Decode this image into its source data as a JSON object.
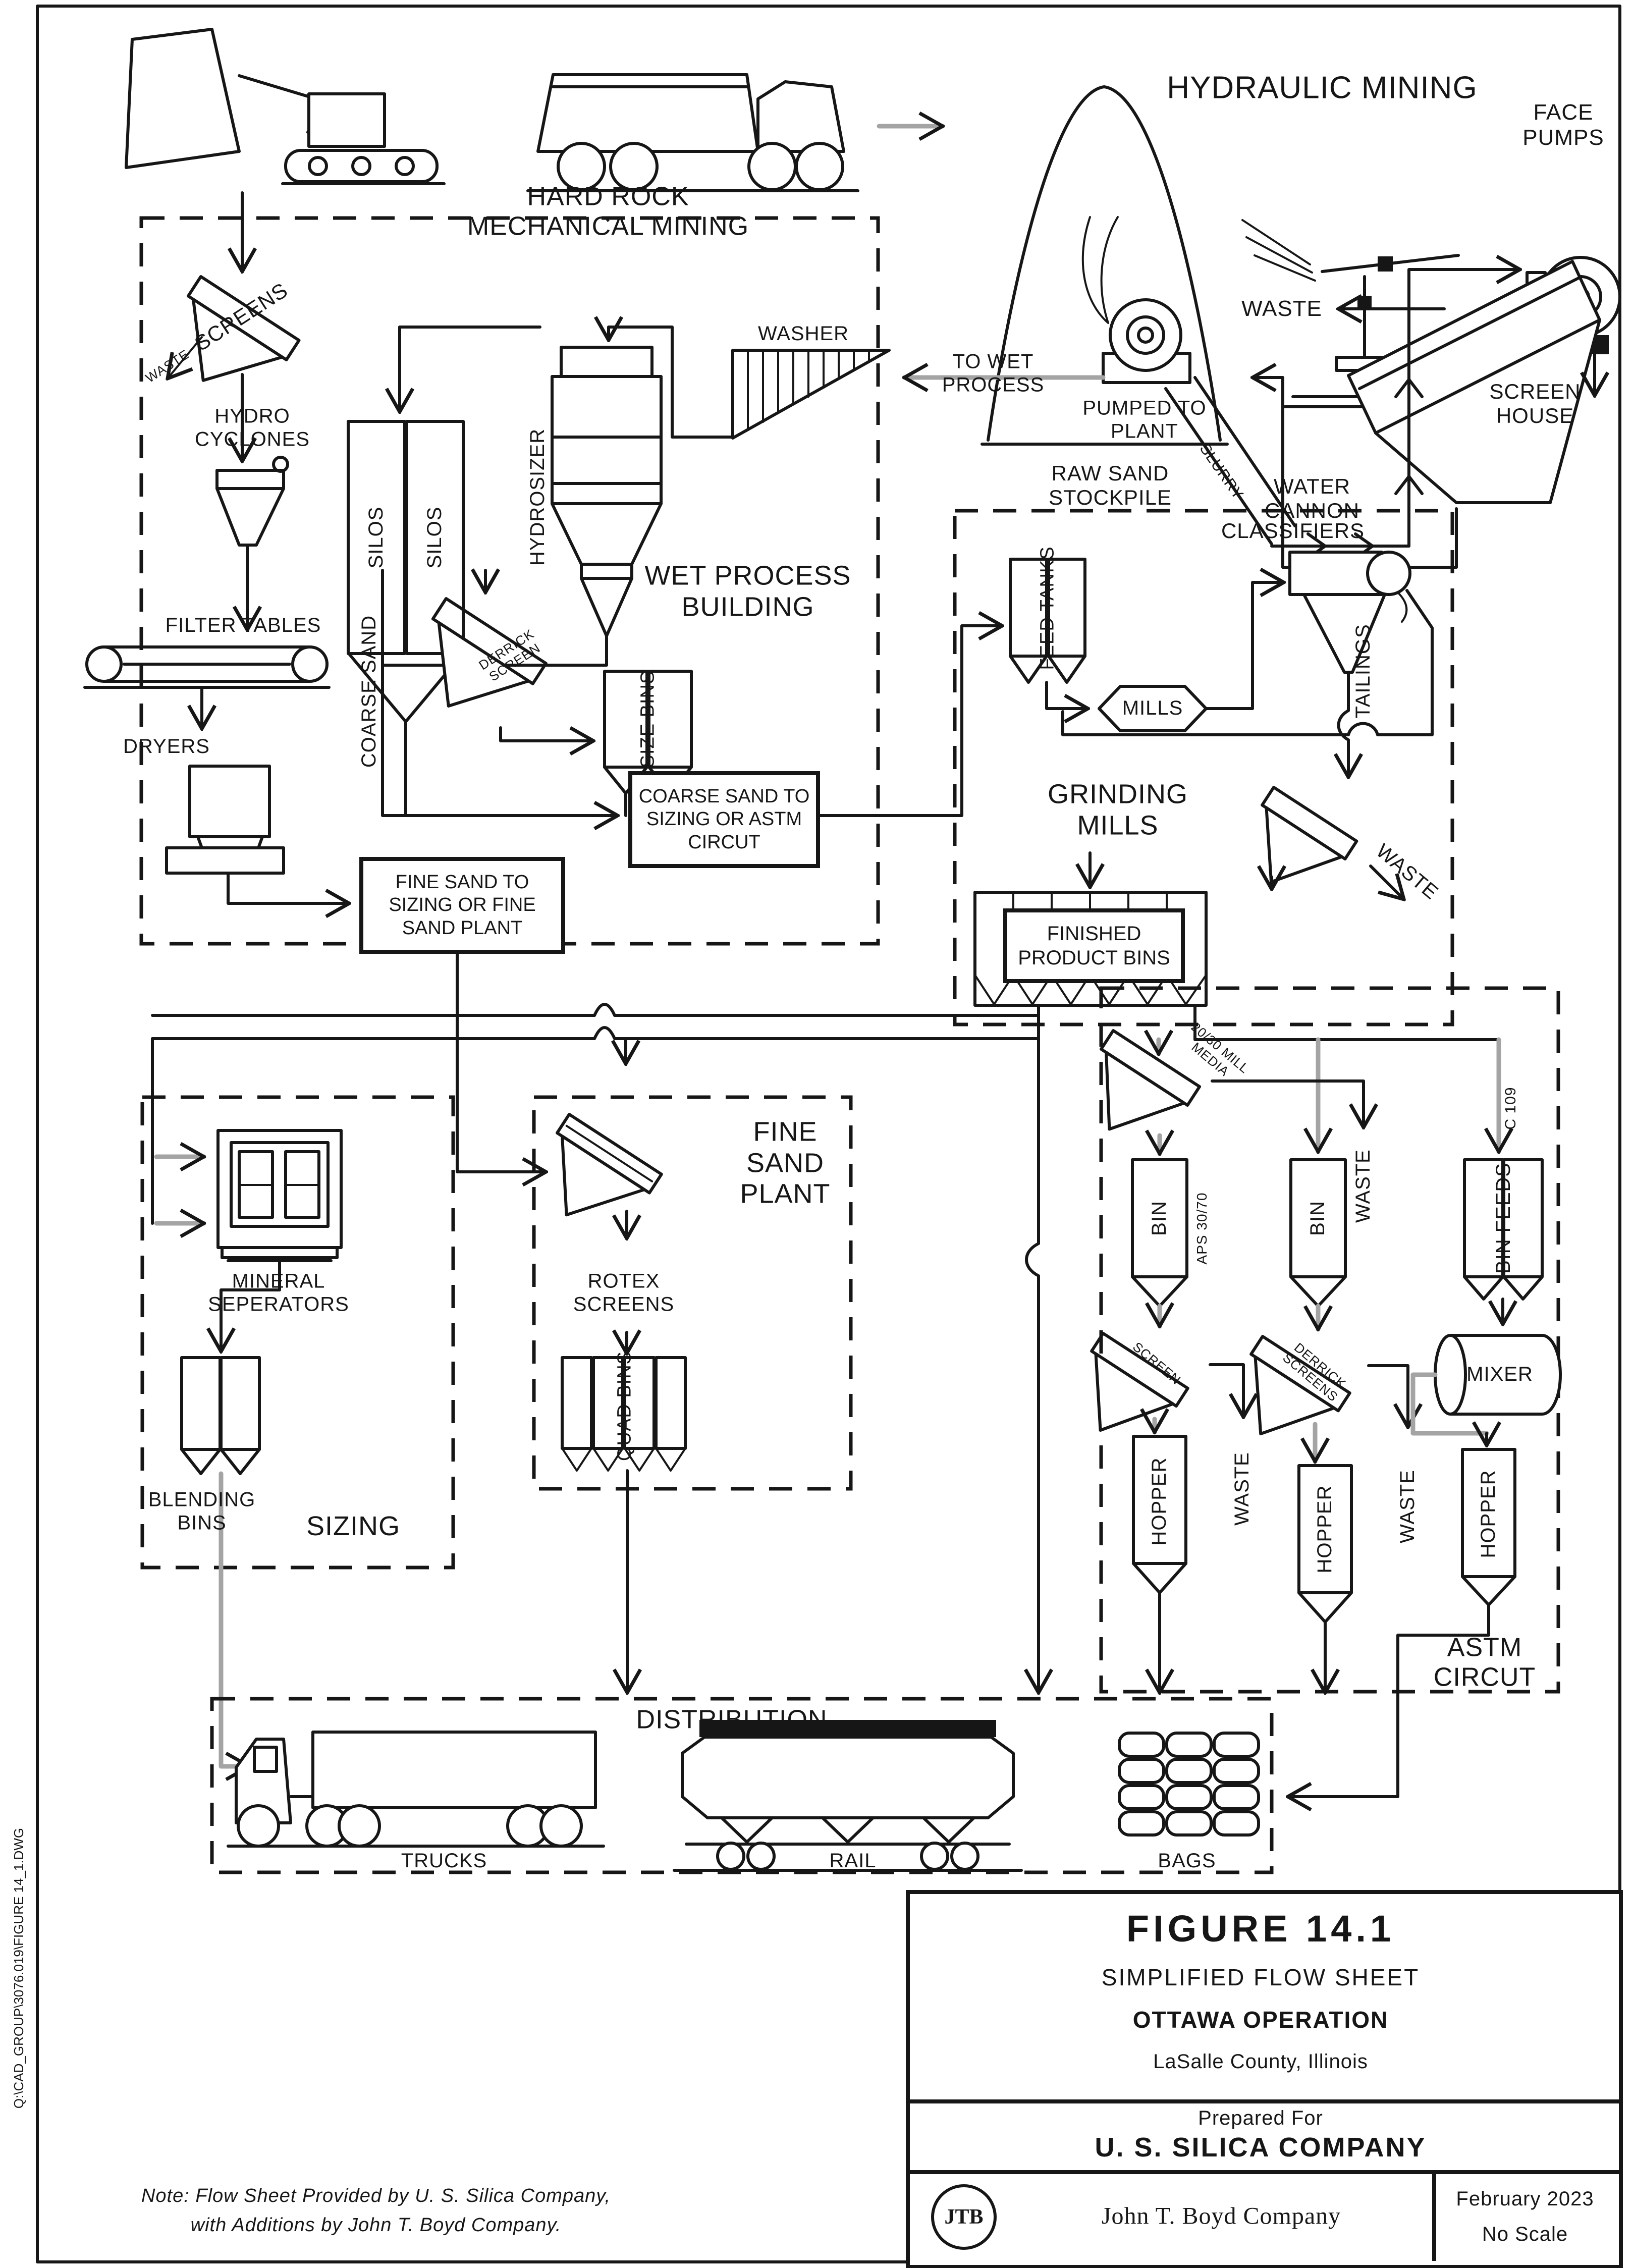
{
  "colors": {
    "ink": "#161616",
    "flow_gray": "#a4a4a4",
    "paper": "#ffffff"
  },
  "mining": {
    "hard_rock": "HARD ROCK MECHANICAL MINING",
    "hydraulic": "HYDRAULIC MINING",
    "face_pumps": "FACE PUMPS",
    "raw_sand_stockpile": "RAW SAND STOCKPILE",
    "water_cannon": "WATER CANNON",
    "slurry": "SLURRY",
    "waste": "WASTE",
    "screen_house": "SCREEN HOUSE",
    "pumped_to_plant": "PUMPED TO PLANT",
    "to_wet_process": "TO WET PROCESS"
  },
  "wet_process": {
    "building": "WET PROCESS BUILDING",
    "screens": "SCREENS",
    "waste": "WASTE",
    "hydro_cyclones": "HYDRO CYCLONES",
    "silos_left": "SILOS",
    "silos_right": "SILOS",
    "hydrosizer": "HYDROSIZER",
    "washer": "WASHER",
    "filter_tables": "FILTER TABLES",
    "dryers": "DRYERS",
    "coarse_sand": "COARSE SAND",
    "derrick_screen": "DERRICK SCREEN",
    "size_bins": "SIZE BINS",
    "coarse_to": "COARSE SAND TO SIZING OR ASTM CIRCUT",
    "fine_to": "FINE SAND TO SIZING OR FINE SAND PLANT"
  },
  "grinding": {
    "title": "GRINDING MILLS",
    "feed_tanks": "FEED TANKS",
    "mills": "MILLS",
    "classifiers": "CLASSIFIERS",
    "tailings": "TAILINGS",
    "waste": "WASTE",
    "finished_product_bins": "FINISHED PRODUCT BINS"
  },
  "astm": {
    "title": "ASTM CIRCUT",
    "mill_media": "20/30 MILL MEDIA",
    "bin_left": "BIN",
    "aps": "APS 30/70",
    "screen_left": "SCREEN",
    "waste_left": "WASTE",
    "hopper_left": "HOPPER",
    "bin_mid": "BIN",
    "waste_top": "WASTE",
    "derrick_screens": "DERRICK SCREENS",
    "waste_mid": "WASTE",
    "hopper_mid": "HOPPER",
    "c109": "C 109",
    "bin_feeds": "BIN FEEDS",
    "mixer": "MIXER",
    "hopper_right": "HOPPER"
  },
  "sizing": {
    "title": "SIZING",
    "mineral_seperators": "MINERAL SEPERATORS",
    "blending_bins": "BLENDING BINS"
  },
  "fine_sand": {
    "title": "FINE SAND PLANT",
    "rotex_screens": "ROTEX SCREENS",
    "quad_bins": "QUAD BINS"
  },
  "distribution": {
    "title": "DISTRIBUTION",
    "trucks": "TRUCKS",
    "rail": "RAIL",
    "bags": "BAGS"
  },
  "title_block": {
    "figure": "FIGURE 14.1",
    "subtitle": "SIMPLIFIED FLOW SHEET",
    "operation": "OTTAWA OPERATION",
    "location": "LaSalle County, Illinois",
    "prepared_for": "Prepared For",
    "company": "U. S. SILICA COMPANY",
    "logo": "JTB",
    "firm": "John T. Boyd Company",
    "date": "February 2023",
    "scale": "No Scale"
  },
  "note": {
    "line1": "Note: Flow Sheet Provided by U. S. Silica Company,",
    "line2": "with Additions by John T. Boyd Company."
  },
  "file_path": "Q:\\CAD_GROUP\\3076.019\\FIGURE 14_1.DWG"
}
